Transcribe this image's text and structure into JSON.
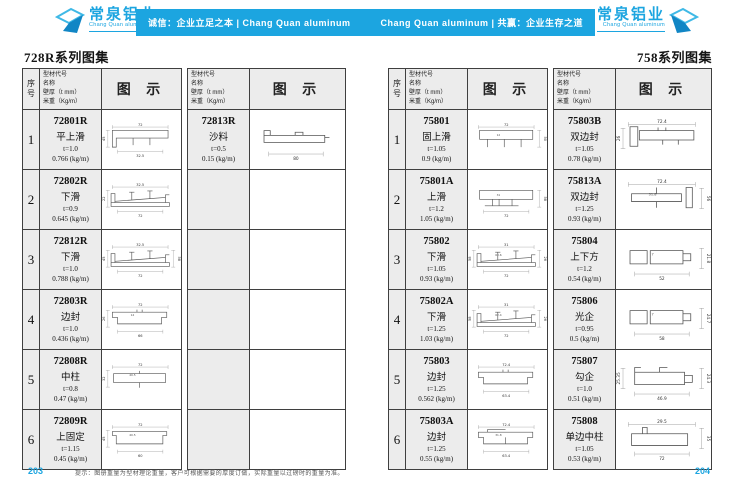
{
  "header": {
    "brand_cn": "常泉铝业",
    "brand_en": "Chang Quan aluminum",
    "banner": {
      "left": "诚信：企业立足之本 | Chang Quan aluminum",
      "right": "Chang Quan aluminum | 共赢：企业生存之道"
    },
    "accent_color": "#1ca5e0"
  },
  "table_header": {
    "index_label": "序号",
    "info_lines": [
      "型材代号",
      "名称",
      "壁厚（t mm）",
      "米重（Kg/m）"
    ],
    "diagram_label": "图 示"
  },
  "left_page": {
    "title": "728R系列图集",
    "page_number": "203",
    "table_a": {
      "rows": [
        {
          "no": "1",
          "code": "72801R",
          "name": "平上滑",
          "thickness": "t=1.0",
          "weight": "0.766 (kg/m)",
          "shape": "toprail",
          "dims": [
            "72",
            "32.5",
            "",
            "45"
          ]
        },
        {
          "no": "2",
          "code": "72802R",
          "name": "下滑",
          "thickness": "t=0.9",
          "weight": "0.645 (kg/m)",
          "shape": "bottomrail",
          "dims": [
            "32.5",
            "72",
            "",
            "22"
          ]
        },
        {
          "no": "3",
          "code": "72812R",
          "name": "下滑",
          "thickness": "t=1.0",
          "weight": "0.788 (kg/m)",
          "shape": "bottomrail",
          "dims": [
            "32.5",
            "72",
            "58",
            "45"
          ]
        },
        {
          "no": "4",
          "code": "72803R",
          "name": "边封",
          "thickness": "t=1.0",
          "weight": "0.436 (kg/m)",
          "shape": "edgeseal",
          "dims": [
            "72",
            "66",
            "",
            "26"
          ],
          "inner": "14"
        },
        {
          "no": "5",
          "code": "72808R",
          "name": "中柱",
          "thickness": "t=0.8",
          "weight": "0.47 (kg/m)",
          "shape": "midpost",
          "dims": [
            "72",
            "",
            "",
            "32"
          ],
          "inner": "40.5"
        },
        {
          "no": "6",
          "code": "72809R",
          "name": "上固定",
          "thickness": "t=1.15",
          "weight": "0.45 (kg/m)",
          "shape": "topfixed",
          "dims": [
            "72",
            "60",
            "",
            "45"
          ],
          "inner": "40.5"
        }
      ]
    },
    "table_b": {
      "rows": [
        {
          "code": "72813R",
          "name": "沙料",
          "thickness": "t=0.5",
          "weight": "0.15 (kg/m)",
          "shape": "screen",
          "dims": [
            "",
            "80",
            "",
            ""
          ]
        },
        {
          "empty": true
        },
        {
          "empty": true
        },
        {
          "empty": true
        },
        {
          "empty": true
        },
        {
          "empty": true
        }
      ]
    }
  },
  "right_page": {
    "title": "758系列图集",
    "page_number": "204",
    "table_a": {
      "rows": [
        {
          "no": "1",
          "code": "75801",
          "name": "固上滑",
          "thickness": "t=1.05",
          "weight": "0.9 (kg/m)",
          "shape": "toprail3",
          "dims": [
            "72",
            "",
            "50",
            ""
          ],
          "inner": "12"
        },
        {
          "no": "2",
          "code": "75801A",
          "name": "上滑",
          "thickness": "t=1.2",
          "weight": "1.05 (kg/m)",
          "shape": "toprail2",
          "dims": [
            "",
            "72",
            "58",
            ""
          ],
          "inner": "31"
        },
        {
          "no": "3",
          "code": "75802",
          "name": "下滑",
          "thickness": "t=1.05",
          "weight": "0.93 (kg/m)",
          "shape": "bottomrail",
          "dims": [
            "31",
            "72",
            "26",
            "58"
          ],
          "inner": "63.6"
        },
        {
          "no": "4",
          "code": "75802A",
          "name": "下滑",
          "thickness": "t=1.25",
          "weight": "1.03 (kg/m)",
          "shape": "bottomrail",
          "dims": [
            "31",
            "72",
            "26",
            "58"
          ],
          "inner": "62.4"
        },
        {
          "no": "5",
          "code": "75803",
          "name": "边封",
          "thickness": "t=1.25",
          "weight": "0.562 (kg/m)",
          "shape": "edgeseal",
          "dims": [
            "72.4",
            "63.4",
            "",
            ""
          ]
        },
        {
          "no": "6",
          "code": "75803A",
          "name": "边封",
          "thickness": "t=1.25",
          "weight": "0.55 (kg/m)",
          "shape": "edgeseal2",
          "dims": [
            "72.4",
            "63.4",
            "",
            ""
          ],
          "inner": "31.8"
        }
      ]
    },
    "table_b": {
      "rows": [
        {
          "code": "75803B",
          "name": "双边封",
          "thickness": "t=1.05",
          "weight": "0.78 (kg/m)",
          "shape": "doubleedge",
          "dims": [
            "72.4",
            "",
            "",
            "26"
          ]
        },
        {
          "code": "75813A",
          "name": "双边封",
          "thickness": "t=1.25",
          "weight": "0.93 (kg/m)",
          "shape": "doubleedge2",
          "dims": [
            "72.4",
            "",
            "56",
            ""
          ],
          "inner": "31.8"
        },
        {
          "code": "75804",
          "name": "上下方",
          "thickness": "t=1.2",
          "weight": "0.54 (kg/m)",
          "shape": "box",
          "dims": [
            "",
            "52",
            "21.8",
            ""
          ],
          "inner": "7"
        },
        {
          "code": "75806",
          "name": "光企",
          "thickness": "t=0.95",
          "weight": "0.5 (kg/m)",
          "shape": "box",
          "dims": [
            "",
            "58",
            "24.7",
            ""
          ],
          "inner": "7"
        },
        {
          "code": "75807",
          "name": "勾企",
          "thickness": "t=1.0",
          "weight": "0.51 (kg/m)",
          "shape": "hook",
          "dims": [
            "",
            "46.9",
            "24.3",
            "25.35"
          ]
        },
        {
          "code": "75808",
          "name": "单边中柱",
          "thickness": "t=1.05",
          "weight": "0.53 (kg/m)",
          "shape": "singlemid",
          "dims": [
            "29.5",
            "72",
            "35",
            ""
          ]
        }
      ]
    }
  },
  "footer_note": "提示：图册重量为型材理论重量，客户可根据需要的厚度订做，实际重量以过磅时的重量为准。"
}
